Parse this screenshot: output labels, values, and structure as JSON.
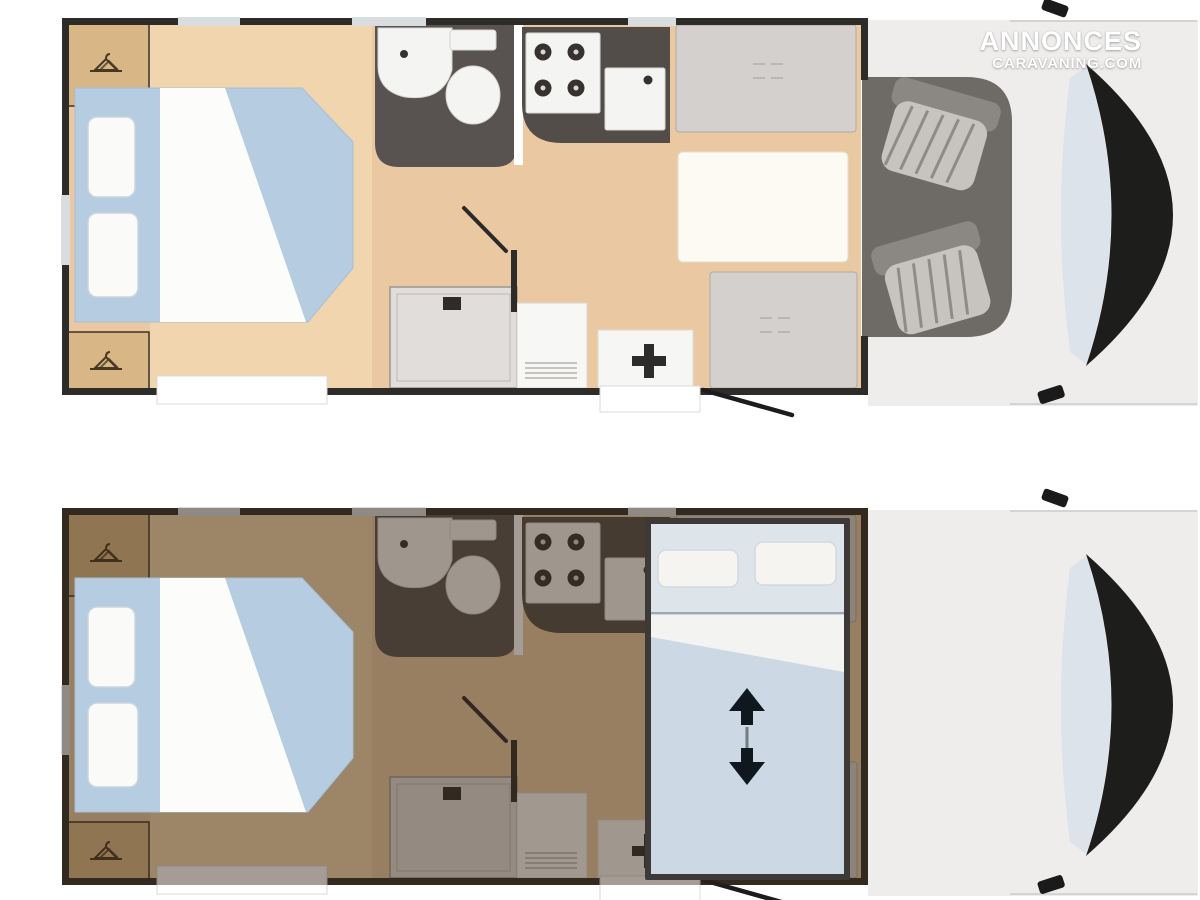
{
  "watermark": {
    "line1": "ANNONCES",
    "line2": "CARAVANING.COM"
  },
  "palette": {
    "wall": "#2e2c29",
    "wood": "#eac9a2",
    "woodLight": "#f2dab4",
    "wardrobe": "#d8b686",
    "hanger": "#463822",
    "bedBlue": "#b5cce1",
    "duvet": "#fcfcfa",
    "pillow": "#fafaf8",
    "pillowEdge": "#ccd5dc",
    "bath": "#585350",
    "fixture": "#f4f4f2",
    "burner": "#35322f",
    "counter": "#524d49",
    "bench": "#d4d0cd",
    "benchEdge": "#aeaaa6",
    "table": "#fcfaf3",
    "shower": "#e0ddda",
    "showerEdge": "#9b9793",
    "cabinet": "#f7f7f5",
    "panel": "#f6f6f4",
    "cross": "#2e2c2a",
    "cabFloor": "#6e6a66",
    "seatBase": "#8b8783",
    "seatCushion": "#c7c4c0",
    "seatStripe": "#8f8c88",
    "body": "#eeedec",
    "bodyLine": "#d5d4d2",
    "glass": "#dde3ea",
    "windshield": "#1d1d1c",
    "window": "#d9dde0",
    "nightOverlay": "rgba(56,38,20,0.45)",
    "dropFrame": "#3c3936",
    "dropBed": "#ccd9e4",
    "dropShelf": "#dde4ea",
    "dropPillow": "#f5f4f1",
    "arrow": "#10181f",
    "doorLine": "#1c1c1c",
    "watermark": "#ffffff"
  },
  "icons": {
    "wardrobe": "hanger-icon",
    "hob": "burner-circles-icon",
    "faucet": "faucet-dot-icon",
    "shower_drain": "drain-icon",
    "heater": "plus-icon",
    "bed_lift_up": "arrow-up-icon",
    "bed_lift_down": "arrow-down-icon"
  }
}
